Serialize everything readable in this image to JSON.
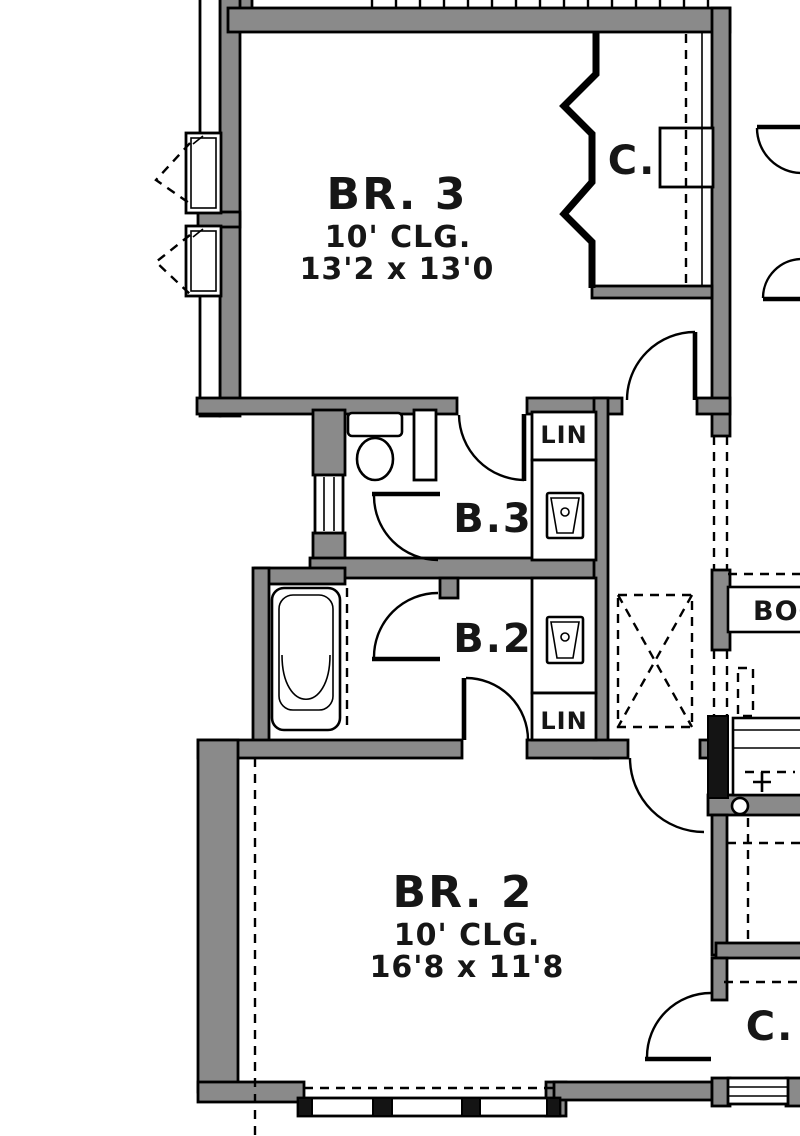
{
  "rooms": {
    "br3": {
      "label": "BR. 3",
      "ceiling": "10' CLG.",
      "dimensions": "13'2 x 13'0"
    },
    "br2": {
      "label": "BR. 2",
      "ceiling": "10' CLG.",
      "dimensions": "16'8 x 11'8"
    },
    "bath3": {
      "label": "B.3"
    },
    "bath2": {
      "label": "B.2"
    },
    "closet_br3": {
      "label": "C."
    },
    "closet_br2": {
      "label": "C."
    },
    "linen_bath3": {
      "label": "LIN"
    },
    "linen_bath2": {
      "label": "LIN"
    },
    "bookshelf": {
      "label": "BOOK"
    }
  },
  "colors": {
    "wall_fill": "#8a8a8a",
    "line": "#000000",
    "background": "#ffffff"
  }
}
